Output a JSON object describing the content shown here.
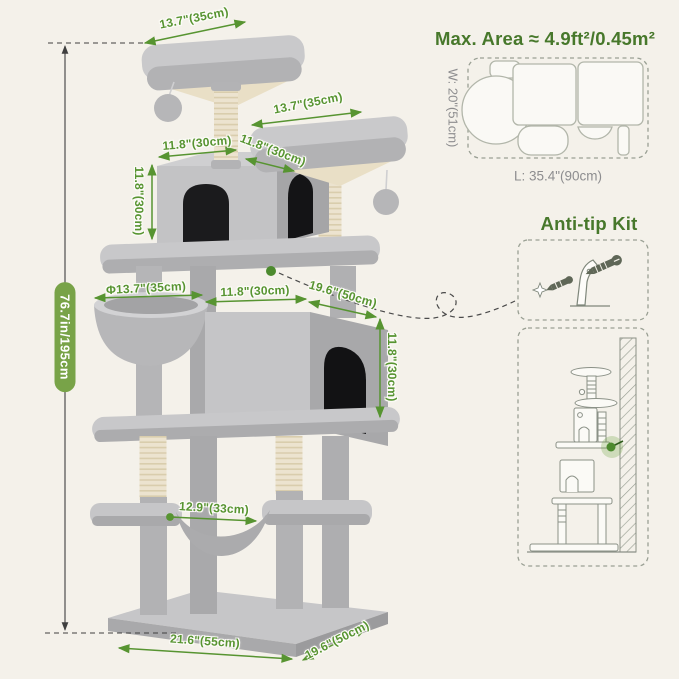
{
  "page": {
    "background": "#f4f1ea"
  },
  "colors": {
    "annotation_green": "#579431",
    "heading_green": "#47782b",
    "badge_green": "#78a348",
    "muted_gray": "#8d8d8f",
    "plush_gray": "#c6c6c8",
    "sisal_beige": "#ece3cf",
    "sketch_stroke": "#8b9187",
    "line_dark": "#3f3f3f"
  },
  "dimensions": {
    "total_height": "76.7in/195cm",
    "top_platform_width": "13.7\"(35cm)",
    "upper_platform_width": "13.7\"(35cm)",
    "top_condo_width": "11.8\"(30cm)",
    "top_condo_depth": "11.8\"(30cm)",
    "top_condo_height": "11.8\"(30cm)",
    "hammock_diameter": "Φ13.7\"(35cm)",
    "big_condo_width": "11.8\"(30cm)",
    "big_condo_depth": "19.6\"(50cm)",
    "big_condo_height": "11.8\"(30cm)",
    "lower_hammock_width": "12.9\"(33cm)",
    "base_length": "21.6\"(55cm)",
    "base_depth": "19.6\"(50cm)"
  },
  "footprint_panel": {
    "title": "Max. Area ≈ 4.9ft²/0.45m²",
    "width_label": "W: 20\"(51cm)",
    "length_label": "L: 35.4\"(90cm)"
  },
  "anti_tip_panel": {
    "title": "Anti-tip Kit"
  }
}
